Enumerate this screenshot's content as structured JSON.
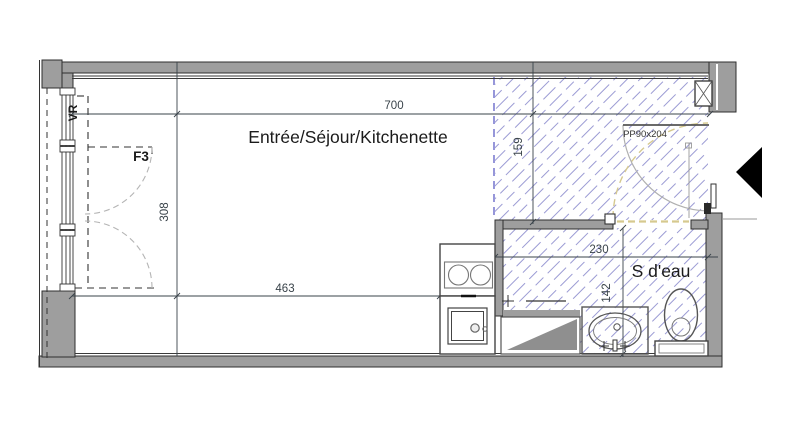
{
  "floorplan": {
    "rooms": [
      {
        "name": "Entrée/Séjour/Kitchenette"
      },
      {
        "name": "S d'eau"
      }
    ],
    "annotations": {
      "window_code": "F3",
      "roller_shutter": "VR",
      "entrance_door_code": "PP90x204"
    },
    "dimensions_cm": {
      "total_width": "700",
      "room_depth": "308",
      "living_width": "463",
      "entry_zone_depth": "159",
      "bathroom_width": "230",
      "bathroom_depth": "142"
    },
    "colors": {
      "wall_gray": "#9e9e9e",
      "hatch_blue": "#9b9bd4",
      "zone_boundary_blue": "#7d7dd0",
      "door_opening_tan": "#d6c98f",
      "line_dark": "#2f2f2f",
      "dimension_text": "#39434a",
      "entry_arrow_black": "#000000"
    },
    "fixtures": [
      "cooktop",
      "kitchen-sink",
      "shower-tray",
      "washbasin",
      "toilet",
      "duct"
    ]
  }
}
